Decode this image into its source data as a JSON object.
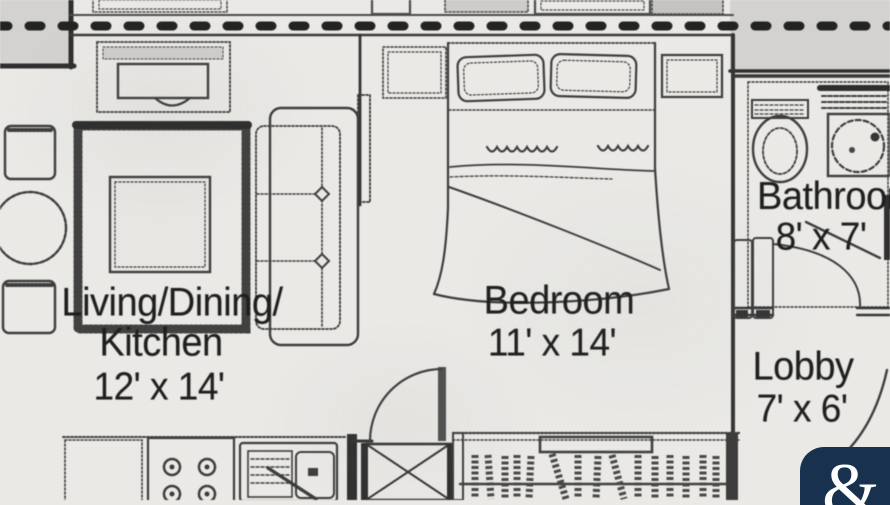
{
  "page": {
    "type": "apartment floor plan photo"
  },
  "rooms": {
    "living": {
      "name_line1": "Living/Dining/",
      "name_line2": "Kitchen",
      "dims": "12' x 14'"
    },
    "bedroom": {
      "name": "Bedroom",
      "dims": "11' x 14'"
    },
    "bathroom": {
      "name": "Bathroom",
      "dims": "8' x 7'"
    },
    "lobby": {
      "name": "Lobby",
      "dims": "7' x 6'"
    }
  },
  "watermark": {
    "glyph": "&"
  },
  "colors": {
    "paper": "#eae9e6",
    "ink": "#3b3b3b",
    "shaded_area": "#d7d5d2",
    "label_text": "#1c1c1c",
    "watermark_bg": "#17314f",
    "watermark_fg": "#ffffff"
  },
  "furniture_icons": [
    "sofa-icon",
    "rug-icon",
    "coffee-table-icon",
    "tv-unit-icon",
    "armchair-icon",
    "round-table-icon",
    "bed-icon",
    "pillow-icon",
    "nightstand-icon",
    "dresser-icon",
    "toilet-icon",
    "sink-vanity-icon",
    "shelf-icon",
    "stove-icon",
    "kitchen-counter-icon",
    "kitchen-sink-icon",
    "wardrobe-icon",
    "shaft-icon",
    "door-swing-icon",
    "property-dashed-line-icon"
  ]
}
